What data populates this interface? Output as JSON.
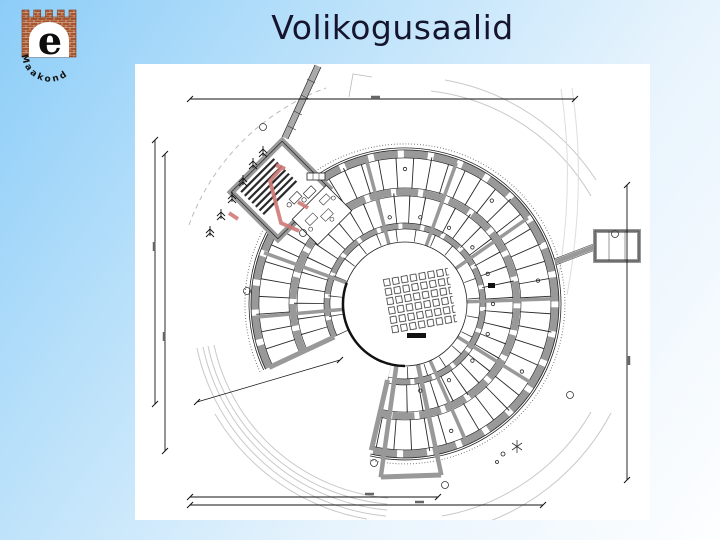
{
  "slide": {
    "title": "Volikogusaalid",
    "title_color": "#15152e",
    "background_top_color": "#8ccdf8",
    "background_bottom_color": "#fdfeff"
  },
  "logo": {
    "letter": "e",
    "arc_text": "Maakond",
    "brick_color": "#a8552e"
  },
  "floorplan": {
    "type": "architectural-drawing",
    "subject": "fan-shaped council building floor plan with central assembly hall",
    "wall_color": "#999999",
    "highlight_color": "#cf7a76"
  }
}
